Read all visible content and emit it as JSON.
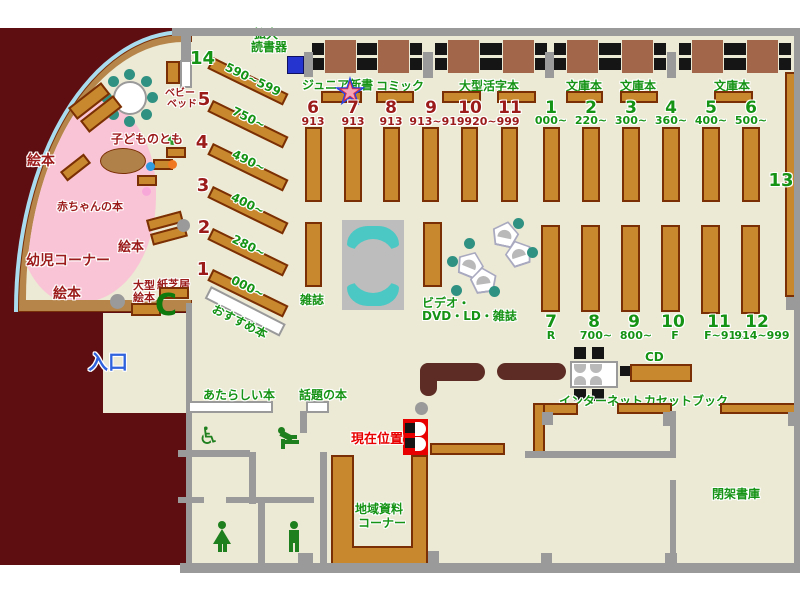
{
  "palette": {
    "floor": "#ECE9D4",
    "outside": "#5E0E10",
    "wall": "#9A9A9A",
    "shelf": "#C8892E",
    "shelf_border": "#7B2F04",
    "green_label": "#149314",
    "dark_red_label": "#9B1A1A",
    "entrance_blue": "#2F62DD",
    "marker_red": "#E80000",
    "teal_chair": "#2F9182",
    "pink_area": "#F9C4D6",
    "window_blue": "#AADCF0",
    "table_brown": "#A2664A",
    "counter_brown": "#5D2D25",
    "device_blue": "#2533CF"
  },
  "labels": {
    "nyuguchi": "入口",
    "ehon_top": "絵本",
    "ehon_mid": "絵本",
    "ehon_btm": "絵本",
    "yoji": "幼児コーナー",
    "akachan": "赤ちゃんの本",
    "kodomo": "子どものとも",
    "baby1": "ベビー",
    "baby2": "ベッド",
    "ogata1": "大型",
    "ogata2": "絵本",
    "kamishibai": "紙芝居",
    "osusume": "おすすめ本",
    "kakudai1": "拡大",
    "kakudai2": "読書器",
    "junior": "ジュニア新書",
    "comic": "コミック",
    "ogata_katsuji": "大型活字本",
    "bunko_a": "文庫本",
    "bunko_b": "文庫本",
    "bunko_c": "文庫本",
    "zasshi": "雑誌",
    "video1": "ビデオ・",
    "video2": "DVD・LD・雑誌",
    "atarashii": "あたらしい本",
    "wadai": "話題の本",
    "genzai": "現在位置",
    "internet": "インターネット",
    "cd": "CD",
    "cassette": "カセットブック",
    "chiiki1": "地域資料",
    "chiiki2": "コーナー",
    "heika": "閉架書庫",
    "num13": "13"
  },
  "g": {
    "diag": [
      {
        "n": "14",
        "r": "590~599"
      },
      {
        "n": "5",
        "r": "750~"
      },
      {
        "n": "4",
        "r": "490~"
      },
      {
        "n": "3",
        "r": "400~"
      },
      {
        "n": "2",
        "r": "280~"
      },
      {
        "n": "1",
        "r": "000~"
      }
    ],
    "topRed": [
      {
        "n": "6",
        "r": "913"
      },
      {
        "n": "7",
        "r": "913"
      },
      {
        "n": "8",
        "r": "913"
      },
      {
        "n": "9",
        "r": "913~919"
      },
      {
        "n": "10",
        "r": "920~999"
      },
      {
        "n": "11",
        "r": ""
      }
    ],
    "topGreen": [
      {
        "n": "1",
        "r": "000~"
      },
      {
        "n": "2",
        "r": "220~"
      },
      {
        "n": "3",
        "r": "300~"
      },
      {
        "n": "4",
        "r": "360~"
      },
      {
        "n": "5",
        "r": "400~"
      },
      {
        "n": "6",
        "r": "500~"
      }
    ],
    "botGreen": [
      {
        "n": "7",
        "r": "R"
      },
      {
        "n": "8",
        "r": "700~"
      },
      {
        "n": "9",
        "r": "800~"
      },
      {
        "n": "10",
        "r": "F"
      },
      {
        "n": "11",
        "r": "F~914"
      },
      {
        "n": "12",
        "r": "914~999"
      }
    ]
  },
  "icons": {
    "wheelchair": "♿",
    "phone": "C"
  }
}
